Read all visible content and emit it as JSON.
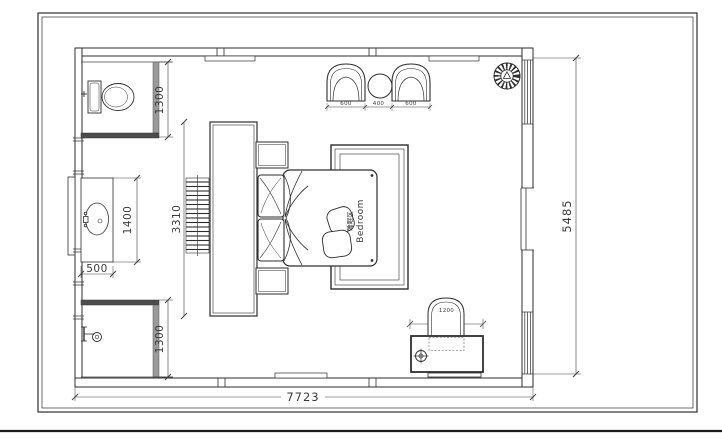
{
  "plan": {
    "room_label": {
      "zh": "睡眠区",
      "en": "Bedroom"
    },
    "dims": {
      "overall_width": "7723",
      "overall_height": "5485",
      "toilet_depth": "1300",
      "vanity_length": "1400",
      "vanity_width": "500",
      "wardrobe_length": "3310",
      "shower_depth": "1300",
      "armchair_left": "600",
      "side_table": "400",
      "armchair_right": "600",
      "desk_width": "1200"
    }
  }
}
